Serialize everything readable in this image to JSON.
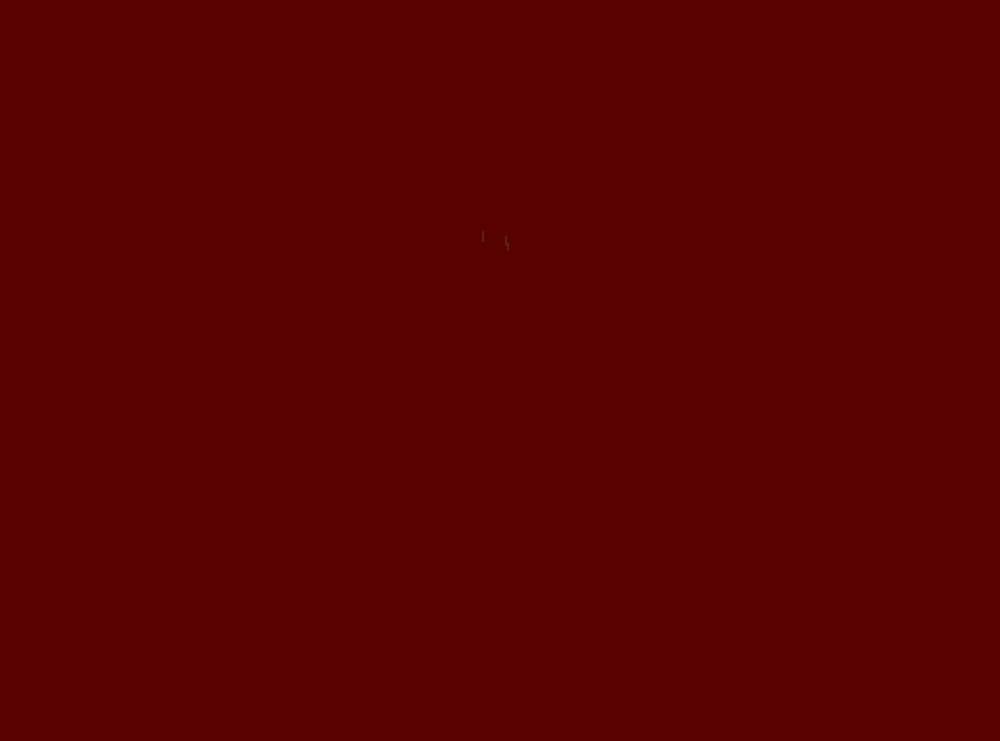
{
  "screen": {
    "background_color": "#570101",
    "visible_text": "",
    "artifact": {
      "name": "faint-cursor-artifact",
      "color": "#6e5e28",
      "opacity": 0.35,
      "marks": [
        {
          "x": 482,
          "y": 231,
          "w": 2,
          "h": 11
        },
        {
          "x": 505,
          "y": 236,
          "w": 2,
          "h": 10
        },
        {
          "x": 507,
          "y": 243,
          "w": 2,
          "h": 8
        }
      ]
    }
  }
}
